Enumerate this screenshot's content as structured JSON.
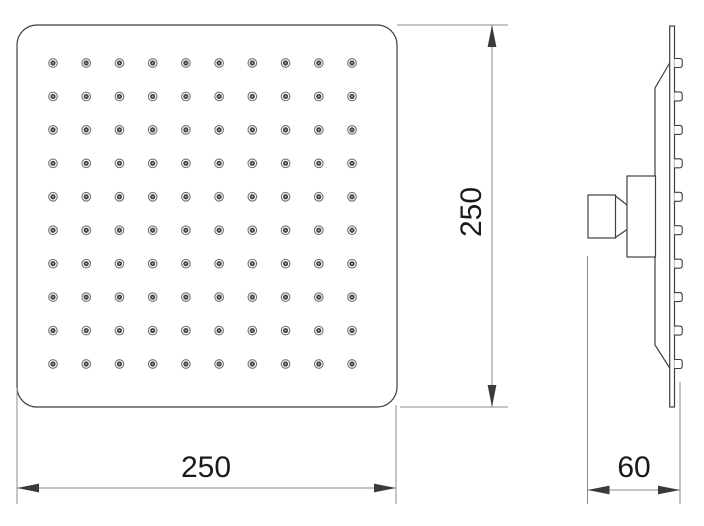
{
  "front_view": {
    "width_label": "250",
    "height_label": "250",
    "nozzle_rows": 10,
    "nozzle_cols": 10
  },
  "side_view": {
    "depth_label": "60",
    "nozzle_count": 10
  },
  "colors": {
    "background": "#ffffff",
    "outline": "#3f3f3f",
    "dim_line": "#8c8c8c",
    "arrow": "#3a3a3a",
    "text": "#1a1a1a",
    "nozzle_ring": "#707070",
    "nozzle_dot": "#454545",
    "nozzle_center": "#b5b5b5"
  }
}
